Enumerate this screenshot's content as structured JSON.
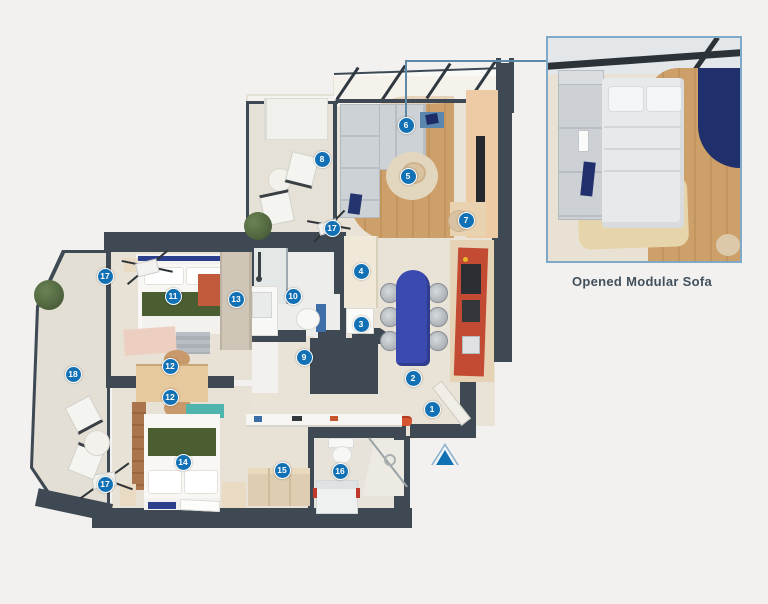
{
  "inset": {
    "caption": "Opened Modular Sofa"
  },
  "entrance_arrow": {
    "x": 445,
    "y": 455,
    "direction": "up"
  },
  "colors": {
    "marker": "#1271b4",
    "wall": "#3e4953",
    "callout": "#5d89a8",
    "caption": "#41505c",
    "inset_border": "#7ea9c9",
    "kitchen_red": "#c34a33",
    "table_blue": "#3b4aae",
    "bed_green": "#4a5e32",
    "teal": "#4fb3ae",
    "wood": "#cb9c63"
  },
  "markers": [
    {
      "label": "1",
      "x": 432,
      "y": 409
    },
    {
      "label": "2",
      "x": 413,
      "y": 378
    },
    {
      "label": "3",
      "x": 361,
      "y": 324
    },
    {
      "label": "4",
      "x": 361,
      "y": 271
    },
    {
      "label": "5",
      "x": 408,
      "y": 176
    },
    {
      "label": "6",
      "x": 406,
      "y": 125
    },
    {
      "label": "7",
      "x": 466,
      "y": 220
    },
    {
      "label": "8",
      "x": 322,
      "y": 159
    },
    {
      "label": "9",
      "x": 304,
      "y": 357
    },
    {
      "label": "10",
      "x": 293,
      "y": 296
    },
    {
      "label": "11",
      "x": 173,
      "y": 296
    },
    {
      "label": "12",
      "x": 170,
      "y": 366
    },
    {
      "label": "12",
      "x": 170,
      "y": 397
    },
    {
      "label": "13",
      "x": 236,
      "y": 299
    },
    {
      "label": "14",
      "x": 183,
      "y": 462
    },
    {
      "label": "15",
      "x": 282,
      "y": 470
    },
    {
      "label": "16",
      "x": 340,
      "y": 471
    },
    {
      "label": "17",
      "x": 332,
      "y": 228
    },
    {
      "label": "17",
      "x": 105,
      "y": 276
    },
    {
      "label": "17",
      "x": 105,
      "y": 484
    },
    {
      "label": "18",
      "x": 73,
      "y": 374
    }
  ]
}
